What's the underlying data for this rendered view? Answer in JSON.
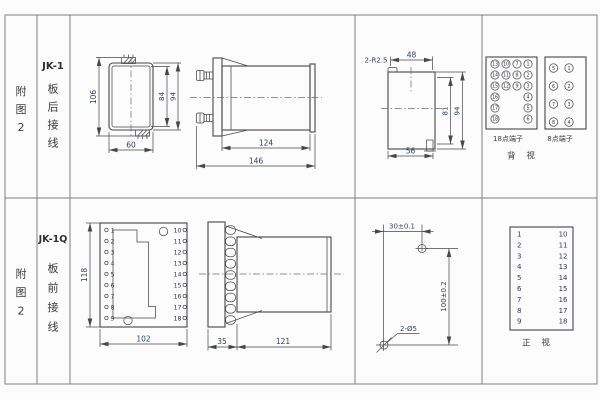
{
  "colors": {
    "line": "#474747",
    "dimension_text": "#2f3e60",
    "background": "#fcfcfc"
  },
  "labels": {
    "fig_top": [
      "附",
      "图",
      "2"
    ],
    "fig_bottom": [
      "附",
      "图",
      "2"
    ],
    "top_model": "JK-1",
    "top_wiring": [
      "板",
      "后",
      "接",
      "线"
    ],
    "bottom_model": "JK-1Q",
    "bottom_wiring": [
      "板",
      "前",
      "接",
      "线"
    ]
  },
  "rear_outline": {
    "h106": "106",
    "h84": "84",
    "h94": "94",
    "w60": "60"
  },
  "rear_side": {
    "w124": "124",
    "w146": "146"
  },
  "cutout": {
    "radius": "2-R2.5",
    "w48": "48",
    "h81": "81",
    "h94": "94",
    "w56": "56"
  },
  "terminals18": {
    "caption": "18点端子",
    "grid": [
      [
        "13",
        "10",
        "7",
        "1"
      ],
      [
        "14",
        "11",
        "8",
        "2"
      ],
      [
        "15",
        "12",
        "9",
        "3"
      ]
    ],
    "left": [
      "16",
      "17",
      "18"
    ],
    "right": [
      "4",
      "5",
      "6"
    ]
  },
  "terminals8": {
    "caption": "8点端子",
    "left": [
      "5",
      "6",
      "7",
      "8"
    ],
    "right": [
      "1",
      "2",
      "3",
      "4"
    ]
  },
  "rear_caption": "背 视",
  "front_outline": {
    "h118": "118",
    "w102": "102",
    "left": [
      "1",
      "2",
      "3",
      "4",
      "5",
      "6",
      "7",
      "8",
      "9"
    ],
    "right": [
      "10",
      "11",
      "12",
      "13",
      "14",
      "15",
      "16",
      "17",
      "18"
    ]
  },
  "front_side": {
    "w35": "35",
    "w121": "121"
  },
  "drill": {
    "w30": "30±0.1",
    "h100": "100±0.2",
    "holes": "2-Ø5"
  },
  "front_table": {
    "caption": "正 视",
    "left": [
      "1",
      "2",
      "3",
      "4",
      "5",
      "6",
      "7",
      "8",
      "9"
    ],
    "right": [
      "10",
      "11",
      "12",
      "13",
      "14",
      "15",
      "16",
      "17",
      "18"
    ]
  }
}
